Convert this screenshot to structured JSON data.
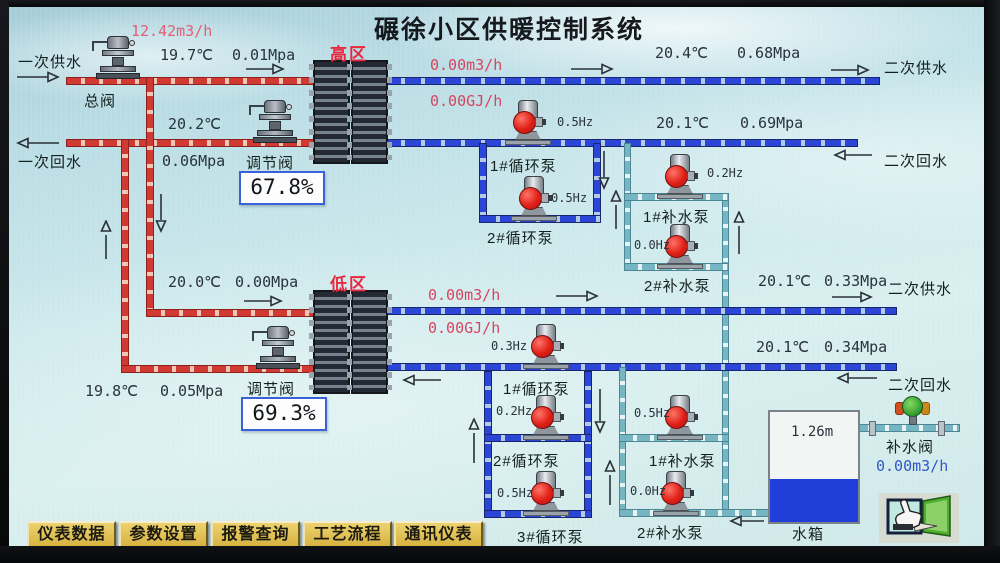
{
  "title": "碾徐小区供暖控制系统",
  "primary": {
    "flow": "12.42m3/h",
    "supply_label": "一次供水",
    "return_label": "一次回水",
    "main_valve_label": "总阀"
  },
  "high_zone": {
    "zone_label": "高区",
    "supply_temp": "19.7℃",
    "supply_pressure": "0.01Mpa",
    "return_temp": "20.2℃",
    "return_pressure": "0.06Mpa",
    "valve_label": "调节阀",
    "valve_opening": "67.8%",
    "sec_flow": "0.00m3/h",
    "sec_energy": "0.00GJ/h",
    "sec_supply_temp": "20.4℃",
    "sec_supply_pressure": "0.68Mpa",
    "sec_supply_label": "二次供水",
    "sec_return_temp": "20.1℃",
    "sec_return_pressure": "0.69Mpa",
    "sec_return_label": "二次回水",
    "pumps": [
      {
        "name": "1#循环泵",
        "freq": "0.5Hz"
      },
      {
        "name": "2#循环泵",
        "freq": "0.5Hz"
      },
      {
        "name": "1#补水泵",
        "freq": "0.2Hz"
      },
      {
        "name": "2#补水泵",
        "freq": "0.0Hz"
      }
    ]
  },
  "low_zone": {
    "zone_label": "低区",
    "supply_temp": "20.0℃",
    "supply_pressure": "0.00Mpa",
    "return_temp": "19.8℃",
    "return_pressure": "0.05Mpa",
    "valve_label": "调节阀",
    "valve_opening": "69.3%",
    "sec_flow": "0.00m3/h",
    "sec_energy": "0.00GJ/h",
    "sec_supply_temp": "20.1℃",
    "sec_supply_pressure": "0.33Mpa",
    "sec_supply_label": "二次供水",
    "sec_return_temp": "20.1℃",
    "sec_return_pressure": "0.34Mpa",
    "sec_return_label": "二次回水",
    "pumps": [
      {
        "name": "1#循环泵",
        "freq": "0.3Hz"
      },
      {
        "name": "2#循环泵",
        "freq": "0.2Hz"
      },
      {
        "name": "3#循环泵",
        "freq": "0.5Hz"
      },
      {
        "name": "1#补水泵",
        "freq": "0.5Hz"
      },
      {
        "name": "2#补水泵",
        "freq": "0.0Hz"
      }
    ]
  },
  "tank": {
    "label": "水箱",
    "level": "1.26m",
    "valve_label": "补水阀",
    "flow": "0.00m3/h"
  },
  "nav_buttons": [
    {
      "label": "仪表数据"
    },
    {
      "label": "参数设置"
    },
    {
      "label": "报警查询"
    },
    {
      "label": "工艺流程"
    },
    {
      "label": "通讯仪表"
    }
  ],
  "icons": {
    "screen_switch": "hand-door-icon"
  },
  "colors": {
    "pipe_red": "#d03a32",
    "pipe_blue": "#2b46d6",
    "pipe_cyan": "#76b6c2",
    "accent_red": "#e82840",
    "value_blue": "#3058c8",
    "button_gold": "#d9b84a"
  }
}
